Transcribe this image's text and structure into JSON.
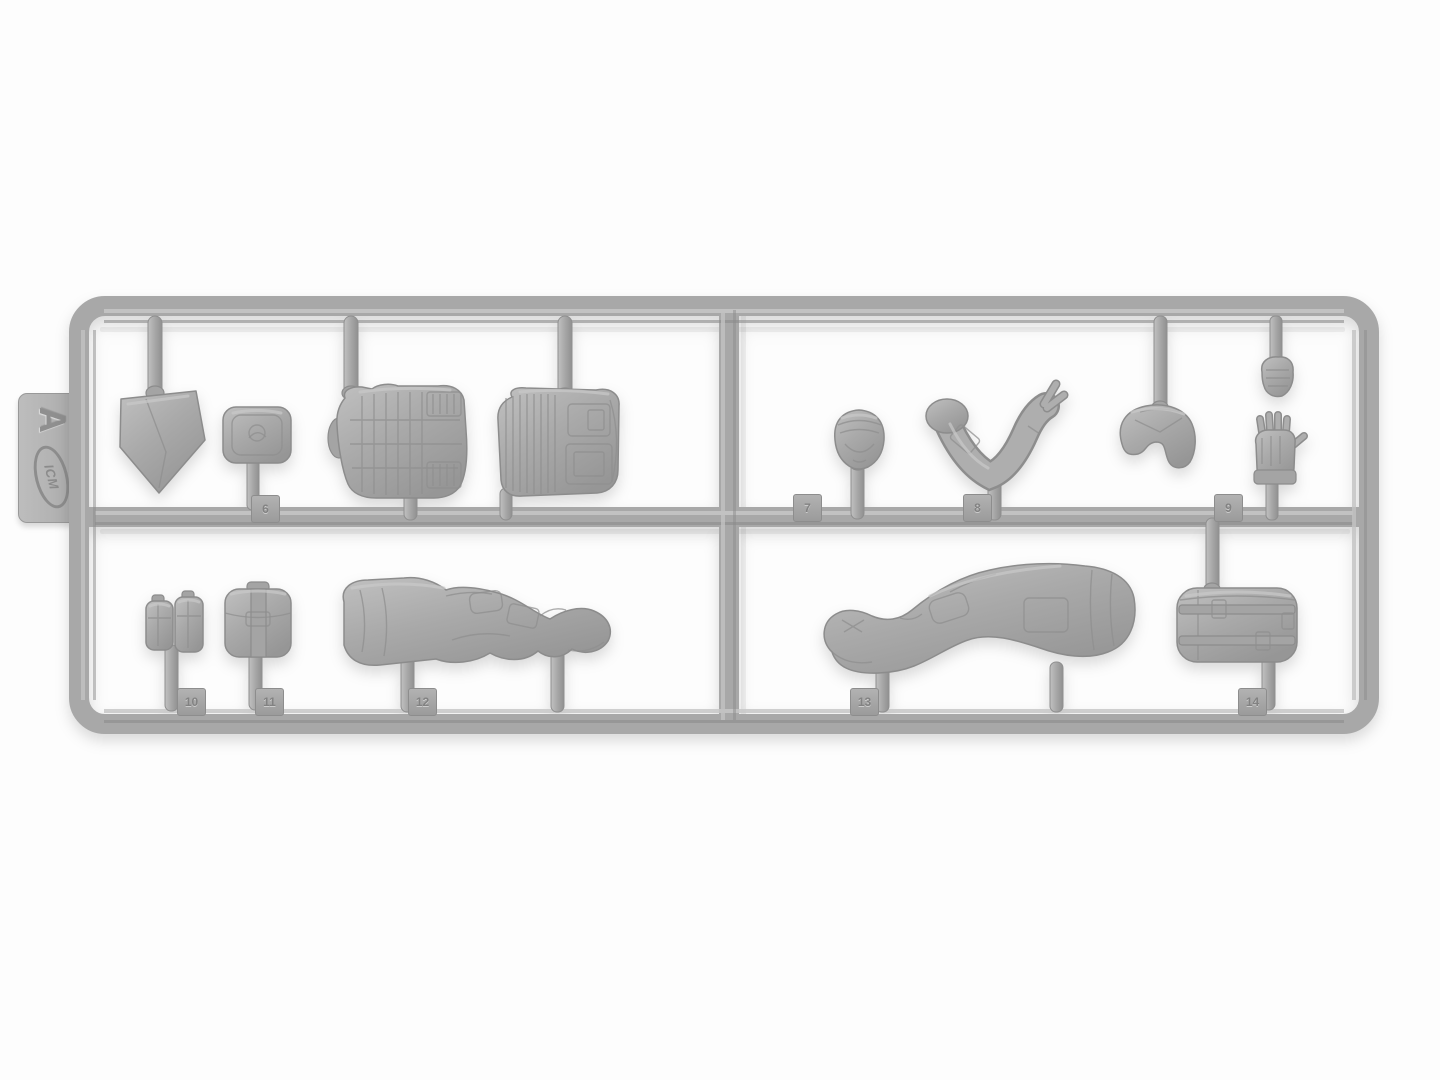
{
  "photo": {
    "description": "Light gray injection-molded plastic model sprue (frame A) holding soldier figure parts, photographed on a white background",
    "background_color": "#fdfdfd",
    "plastic_color": "#ababab",
    "plastic_highlight": "#c9c9c9",
    "plastic_shadow": "#8d8d8d"
  },
  "label_tab": {
    "brand": "ICM",
    "sprue_letter": "A"
  },
  "part_tags": [
    {
      "number": "6",
      "part": "utility-pouch"
    },
    {
      "number": "7",
      "part": "head-with-helmet"
    },
    {
      "number": "8",
      "part": "pointing-arm"
    },
    {
      "number": "9",
      "part": "gloved-hand"
    },
    {
      "number": "10",
      "part": "double-pouch"
    },
    {
      "number": "11",
      "part": "buckled-pouch"
    },
    {
      "number": "12",
      "part": "seated-legs-left"
    },
    {
      "number": "13",
      "part": "seated-legs-right"
    },
    {
      "number": "14",
      "part": "backpack"
    }
  ],
  "parts": [
    {
      "id": "shovel-blade",
      "label": "entrenching shovel blade"
    },
    {
      "id": "utility-pouch",
      "label": "small utility pouch"
    },
    {
      "id": "vest-front",
      "label": "tactical vest torso, front half with MOLLE webbing"
    },
    {
      "id": "vest-back",
      "label": "tactical vest torso, back half"
    },
    {
      "id": "head",
      "label": "head wearing helmet"
    },
    {
      "id": "pointing-arm",
      "label": "bent arm with hand pointing"
    },
    {
      "id": "bent-arm",
      "label": "arm bent at elbow"
    },
    {
      "id": "small-hand",
      "label": "small clenched hand"
    },
    {
      "id": "gloved-hand",
      "label": "gloved open hand with extended thumb"
    },
    {
      "id": "double-pouch",
      "label": "double magazine pouch"
    },
    {
      "id": "buckled-pouch",
      "label": "pouch with central strap and buckle"
    },
    {
      "id": "seated-legs-left",
      "label": "seated legs, first figure"
    },
    {
      "id": "seated-legs-right",
      "label": "seated legs, second figure"
    },
    {
      "id": "backpack",
      "label": "backpack with straps"
    }
  ]
}
